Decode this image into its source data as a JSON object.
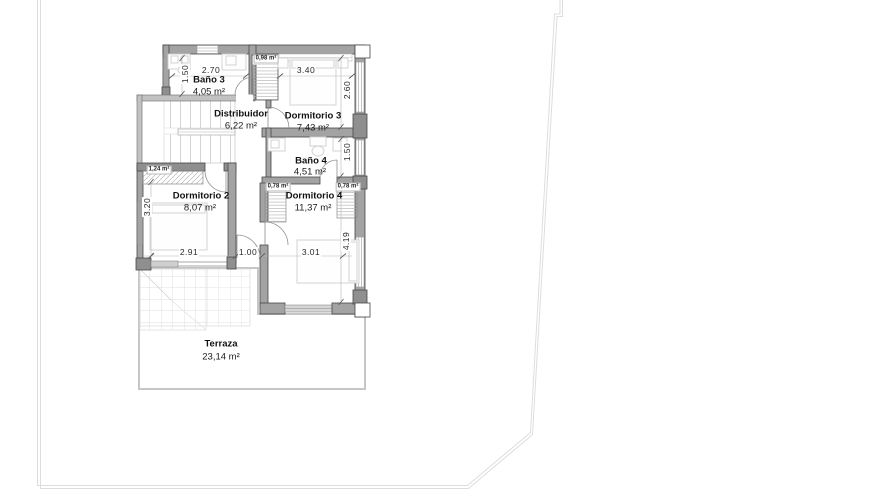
{
  "drawing": {
    "type": "floor-plan",
    "language": "es",
    "colors": {
      "wall_fill": "#a3a3a3",
      "wall_dark": "#8f8f8f",
      "wall_light": "#c2c2c2",
      "furniture_line": "#cfcfcf",
      "plot_boundary": "#dbdee1",
      "terrace_outline": "#c6c6c6",
      "text": "#111111"
    }
  },
  "rooms": {
    "bano3": {
      "name": "Baño 3",
      "area": "4,05 m²"
    },
    "distribuidor": {
      "name": "Distribuidor",
      "area": "6,22 m²"
    },
    "dormitorio3": {
      "name": "Dormitorio 3",
      "area": "7,43 m²"
    },
    "bano4": {
      "name": "Baño 4",
      "area": "4,51 m²"
    },
    "dormitorio2": {
      "name": "Dormitorio 2",
      "area": "8,07 m²"
    },
    "dormitorio4": {
      "name": "Dormitorio 4",
      "area": "11,37 m²"
    },
    "terraza": {
      "name": "Terraza",
      "area": "23,14 m²"
    }
  },
  "small_areas": {
    "shaft": "0,98 m²",
    "wardrobe_d2": "1,24 m²",
    "wardrobe_d4a": "0,78 m²",
    "wardrobe_d4b": "0,78 m²"
  },
  "dimensions": {
    "bano3_height": "1.50",
    "bano3_width": "2.70",
    "dorm3_width": "3.40",
    "dorm3_height": "2.60",
    "bano4_height": "1.50",
    "dorm2_height": "3.20",
    "dorm2_width": "2.91",
    "hall_width": "1.00",
    "dorm4_width": "3.01",
    "dorm4_height": "4.19"
  }
}
